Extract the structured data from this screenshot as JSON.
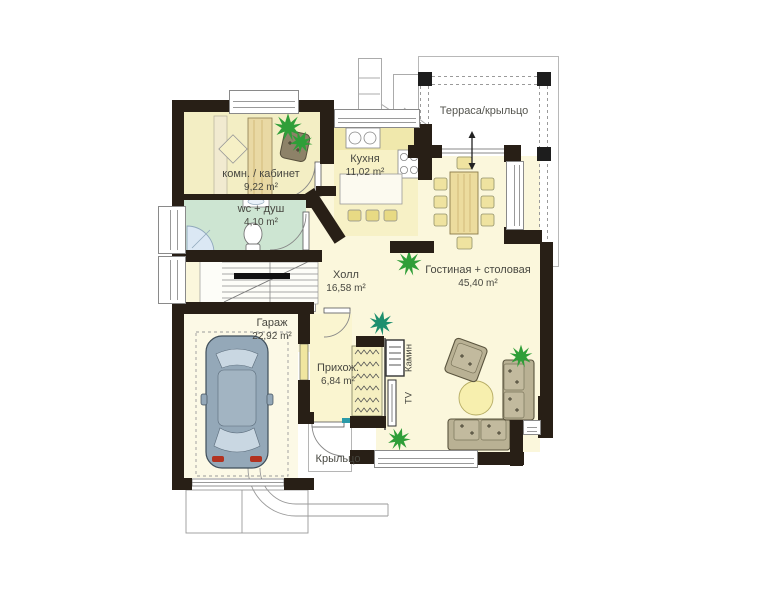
{
  "plan": {
    "rooms": {
      "terrace": {
        "label": "Терраса/крыльцо"
      },
      "study": {
        "label": "комн. / кабинет",
        "area": "9,22 m²"
      },
      "wc": {
        "label": "wc + душ",
        "area": "4,10 m²"
      },
      "kitchen": {
        "label": "Кухня",
        "area": "11,02 m²"
      },
      "hall": {
        "label": "Холл",
        "area": "16,58 m²"
      },
      "living": {
        "label": "Гостиная + столовая",
        "area": "45,40 m²"
      },
      "garage": {
        "label": "Гараж",
        "area": "22,92 m²"
      },
      "entry": {
        "label": "Прихож.",
        "area": "6,84 m²"
      },
      "porch": {
        "label": "Крыльцо"
      },
      "fireplace": {
        "label": "Камин"
      },
      "tv": {
        "label": "TV"
      }
    },
    "colors": {
      "wall": "#281f16",
      "floor": "#fbf7dc",
      "study_floor": "#f3eec4",
      "kitchen_floor": "#f7f1c6",
      "wc_floor": "#cde5d2",
      "garage_floor": "#fcf9e6",
      "entry_floor": "#faf5d0",
      "plant": "#2f9e38",
      "plant_teal": "#1d8f6e",
      "sofa": "#b9b194",
      "wood": "#e9d9a4",
      "car_body": "#94a8b8",
      "car_glass": "#c9d7e2",
      "threshold": "#2a9aa8",
      "taillight": "#b23220"
    }
  }
}
